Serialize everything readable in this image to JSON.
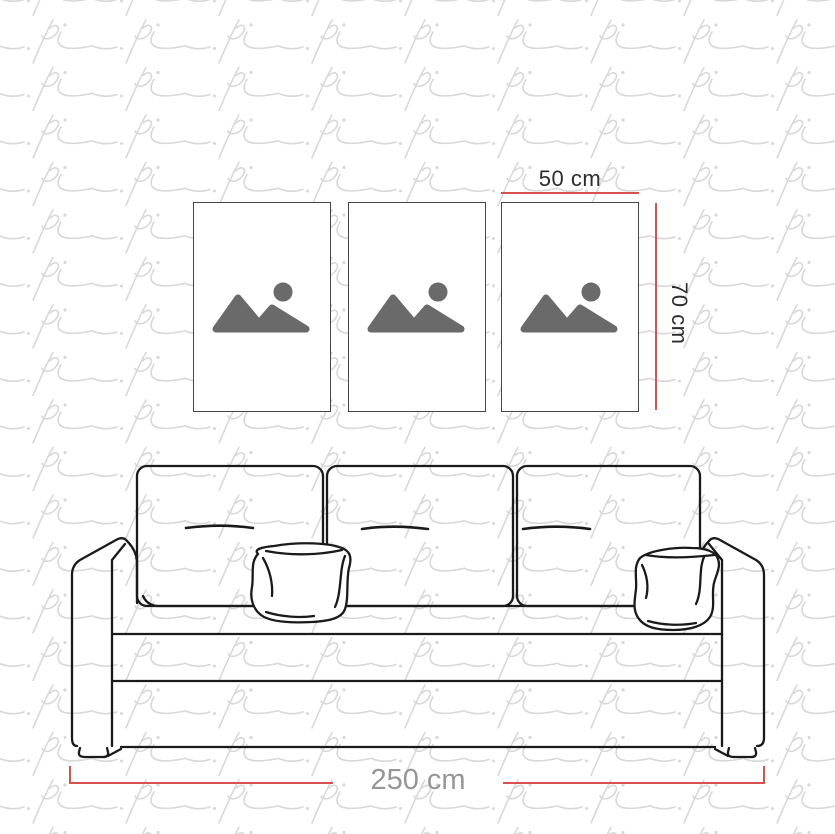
{
  "watermark": {
    "glyph": "pi",
    "color": "#d8d8d8"
  },
  "frames": {
    "count": 3,
    "border_color": "#454545",
    "placeholder_icon": "image-placeholder-icon",
    "icon_color": "#6a6a6a"
  },
  "measurements": {
    "line_color": "#d9514e",
    "frame_width": {
      "label": "50 cm",
      "text_color": "#2c2c2c"
    },
    "frame_height": {
      "label": "70 cm",
      "text_color": "#2c2c2c"
    },
    "sofa_width": {
      "label": "250 cm",
      "text_color": "#969696"
    }
  },
  "sofa": {
    "style": "outline-line-art",
    "line_color": "#1a1a1a",
    "back_cushions": 3,
    "throw_pillows": 2
  }
}
